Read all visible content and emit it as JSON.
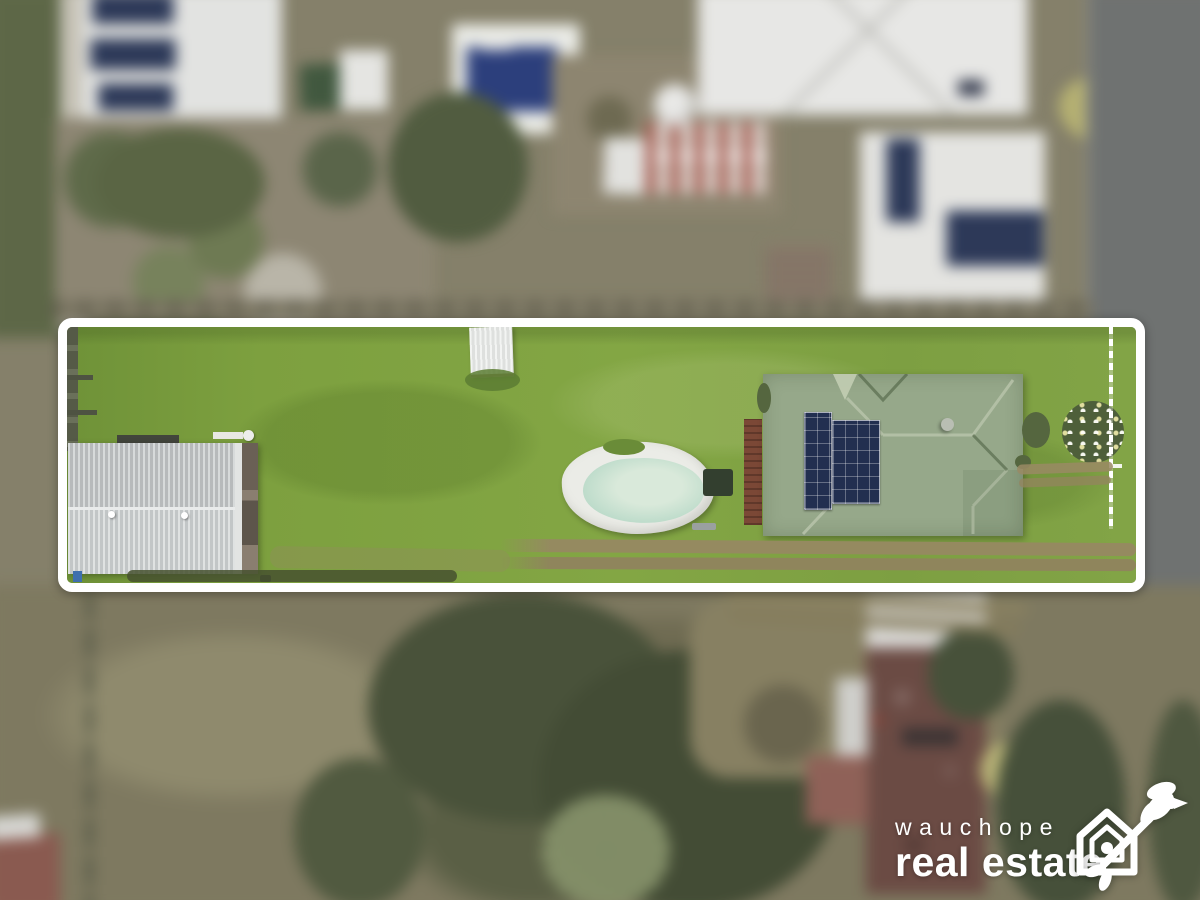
{
  "watermark": {
    "brand_top": "wauchope",
    "brand_bottom": "real estate",
    "icon": "house-with-bird-logo"
  },
  "scene": {
    "type": "aerial drone photograph",
    "highlight": "white outlined boundary around a long narrow residential lot",
    "features": [
      "bright green lawn",
      "grey-roofed garage cottage on left",
      "small white corrugated shed at top",
      "in-ground pool with white surround and pale green water",
      "sage-green roofed house with rooftop solar panel array",
      "white picket fence at right end",
      "double dirt driveway tracks along bottom",
      "white flowering shrub near fence",
      "blurred neighbouring houses, gardens, trees and road around the lot"
    ]
  },
  "colors": {
    "boundary": "#ffffff",
    "lawn": "#7da03f",
    "lawn_dark": "#6d8f37",
    "garage_roof_upper": "#c2c6c7",
    "garage_roof_lower": "#ced2d3",
    "house_roof": "#96a88a",
    "house_roof_light": "#b6c2a8",
    "solar_dark": "#222f50",
    "pool_deck": "#ebece7",
    "pool_water": "#bedccb",
    "pool_water_light": "#d9e9da",
    "neighbor_pool_blue": "#2c3f7c",
    "road_grey": "#6f7271",
    "scrub_tan": "#85806a",
    "veg_green": "#5d6747",
    "tree_dark": "#49523a",
    "brown_roof": "#6b4b44",
    "deck_red": "#96665c",
    "dirt_track": "#958a60",
    "fence_dark": "#555a47",
    "watermark_white": "#ffffff"
  }
}
